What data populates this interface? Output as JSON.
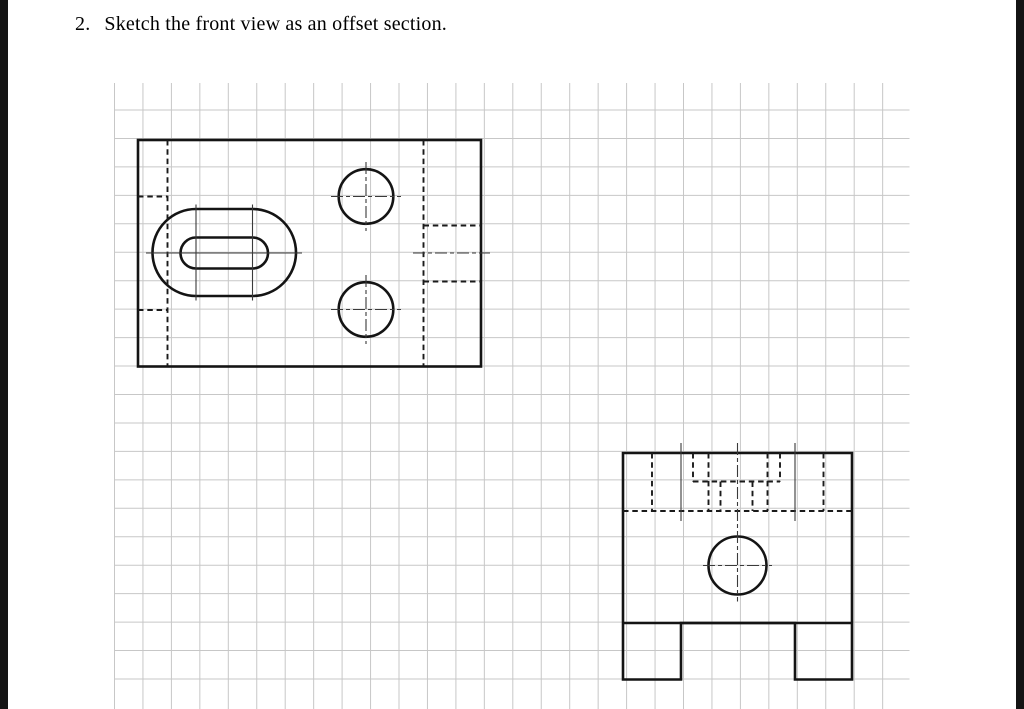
{
  "title": {
    "number": "2.",
    "text": "Sketch the front view as an offset section."
  },
  "page": {
    "background": "#ffffff",
    "edge_bar_color": "#141414",
    "line_color": "#141414",
    "centerline_color": "#3a3a3a"
  },
  "grid": {
    "color": "#c7c7c7",
    "spacing": 28.45,
    "v_start": 114.5,
    "v_end": 910,
    "v_y1": 83,
    "v_y2": 709,
    "h_start": 110,
    "h_end": 683,
    "h_x1": 114.5,
    "h_x2": 909.5
  },
  "drawing": {
    "views": [
      {
        "name": "top-view",
        "shapes": [
          {
            "name": "top-view-outline",
            "type": "rect",
            "cls": "outline",
            "x": 138,
            "y": 140,
            "w": 343,
            "h": 226.5
          },
          {
            "name": "counterbore-slot-outer",
            "type": "path",
            "cls": "outline",
            "d": "M 196 209 L 252.5 209 A 43.5 43.5 0 0 1 252.5 296 L 196 296 A 43.5 43.5 0 0 1 196 209 Z"
          },
          {
            "name": "through-slot-inner",
            "type": "path",
            "cls": "outline",
            "d": "M 196 237.5 L 252.5 237.5 A 15.5 15.5 0 0 1 252.5 268.5 L 196 268.5 A 15.5 15.5 0 0 1 196 237.5 Z"
          },
          {
            "name": "hole-top-circle",
            "type": "circle",
            "cls": "outline",
            "cx": 366,
            "cy": 196.5,
            "r": 27.3
          },
          {
            "name": "hole-bottom-circle",
            "type": "circle",
            "cls": "outline",
            "cx": 366,
            "cy": 309.5,
            "r": 27.3
          },
          {
            "name": "hidden-leg-right-edge",
            "type": "line",
            "cls": "hidden",
            "x1": 167.5,
            "y1": 140,
            "x2": 167.5,
            "y2": 366.5
          },
          {
            "name": "hidden-leg-front-inner-edge",
            "type": "line",
            "cls": "hidden",
            "x1": 138,
            "y1": 196.5,
            "x2": 167.5,
            "y2": 196.5
          },
          {
            "name": "hidden-leg-back-inner-edge",
            "type": "line",
            "cls": "hidden",
            "x1": 138,
            "y1": 310,
            "x2": 167.5,
            "y2": 310
          },
          {
            "name": "hidden-side-hole-depth",
            "type": "line",
            "cls": "hidden",
            "x1": 423.5,
            "y1": 140,
            "x2": 423.5,
            "y2": 366.5
          },
          {
            "name": "hidden-side-hole-near-edge",
            "type": "line",
            "cls": "hidden",
            "x1": 423.5,
            "y1": 225.5,
            "x2": 481,
            "y2": 225.5
          },
          {
            "name": "hidden-side-hole-far-edge",
            "type": "line",
            "cls": "hidden",
            "x1": 423.5,
            "y1": 281.5,
            "x2": 481,
            "y2": 281.5
          },
          {
            "name": "slot-arc-centerline-left",
            "type": "line",
            "cls": "center",
            "x1": 196,
            "y1": 204.5,
            "x2": 196,
            "y2": 300.5
          },
          {
            "name": "slot-arc-centerline-right",
            "type": "line",
            "cls": "center",
            "x1": 252.5,
            "y1": 204.5,
            "x2": 252.5,
            "y2": 300.5
          },
          {
            "name": "slot-centerline-horizontal",
            "type": "line",
            "cls": "center",
            "x1": 146,
            "y1": 253,
            "x2": 302,
            "y2": 253
          },
          {
            "name": "hole-top-centerline-h",
            "type": "line",
            "cls": "cdash",
            "dash": "4 3 14 3",
            "x1": 331,
            "y1": 196.5,
            "x2": 401,
            "y2": 196.5
          },
          {
            "name": "hole-top-centerline-v",
            "type": "line",
            "cls": "cdash",
            "dash": "4 3 14 3",
            "x1": 366,
            "y1": 162,
            "x2": 366,
            "y2": 231
          },
          {
            "name": "hole-bottom-centerline-h",
            "type": "line",
            "cls": "cdash",
            "dash": "4 3 14 3",
            "x1": 331,
            "y1": 309.5,
            "x2": 401,
            "y2": 309.5
          },
          {
            "name": "hole-bottom-centerline-v",
            "type": "line",
            "cls": "cdash",
            "dash": "4 3 14 3",
            "x1": 366,
            "y1": 275,
            "x2": 366,
            "y2": 344
          },
          {
            "name": "side-hole-axis-centerline",
            "type": "line",
            "cls": "cdash",
            "dash": "20 4 5 4",
            "x1": 413,
            "y1": 253,
            "x2": 490,
            "y2": 253
          }
        ]
      },
      {
        "name": "side-view",
        "shapes": [
          {
            "name": "side-view-outline",
            "type": "path",
            "cls": "outline",
            "d": "M 623 453 L 852 453 L 852 679.5 L 795 679.5 L 795 623 L 681 623 L 681 679.5 L 623 679.5 Z"
          },
          {
            "name": "body-bottom-edge",
            "type": "line",
            "cls": "outline",
            "x1": 623,
            "y1": 623,
            "x2": 852,
            "y2": 623
          },
          {
            "name": "side-hole-circle",
            "type": "circle",
            "cls": "outline",
            "cx": 737.5,
            "cy": 565.5,
            "r": 29
          },
          {
            "name": "hidden-hole1-outer-edge",
            "type": "line",
            "cls": "hidden",
            "x1": 652,
            "y1": 453,
            "x2": 652,
            "y2": 511
          },
          {
            "name": "hidden-hole2-outer-edge",
            "type": "line",
            "cls": "hidden",
            "x1": 823.5,
            "y1": 453,
            "x2": 823.5,
            "y2": 511
          },
          {
            "name": "hidden-hole1-inner-edge",
            "type": "line",
            "cls": "hidden",
            "x1": 708.5,
            "y1": 453,
            "x2": 708.5,
            "y2": 511
          },
          {
            "name": "hidden-hole2-inner-edge",
            "type": "line",
            "cls": "hidden",
            "x1": 767.5,
            "y1": 453,
            "x2": 767.5,
            "y2": 511
          },
          {
            "name": "hidden-counterbore-left-wall",
            "type": "line",
            "cls": "hidden",
            "x1": 693,
            "y1": 453,
            "x2": 693,
            "y2": 481.5
          },
          {
            "name": "hidden-counterbore-right-wall",
            "type": "line",
            "cls": "hidden",
            "x1": 780,
            "y1": 453,
            "x2": 780,
            "y2": 481.5
          },
          {
            "name": "hidden-slot-left-wall",
            "type": "line",
            "cls": "hidden",
            "x1": 720.5,
            "y1": 481.5,
            "x2": 720.5,
            "y2": 511
          },
          {
            "name": "hidden-slot-right-wall",
            "type": "line",
            "cls": "hidden",
            "x1": 752.5,
            "y1": 481.5,
            "x2": 752.5,
            "y2": 511
          },
          {
            "name": "hidden-counterbore-bottom",
            "type": "line",
            "cls": "hidden",
            "x1": 693,
            "y1": 481.5,
            "x2": 780,
            "y2": 481.5
          },
          {
            "name": "hidden-internal-step",
            "type": "line",
            "cls": "hidden",
            "x1": 623,
            "y1": 511,
            "x2": 852,
            "y2": 511
          },
          {
            "name": "hole1-centerline",
            "type": "line",
            "cls": "center",
            "x1": 681,
            "y1": 443,
            "x2": 681,
            "y2": 521
          },
          {
            "name": "hole2-centerline",
            "type": "line",
            "cls": "center",
            "x1": 795,
            "y1": 443,
            "x2": 795,
            "y2": 521
          },
          {
            "name": "main-vertical-centerline",
            "type": "line",
            "cls": "cdash",
            "dash": "14 3.5 4.5 3.5",
            "x1": 737.5,
            "y1": 443,
            "x2": 737.5,
            "y2": 601.5
          },
          {
            "name": "side-hole-centerline-h",
            "type": "line",
            "cls": "cdash",
            "dash": "4 3 14 3",
            "x1": 703,
            "y1": 565.5,
            "x2": 772,
            "y2": 565.5
          }
        ]
      }
    ]
  }
}
